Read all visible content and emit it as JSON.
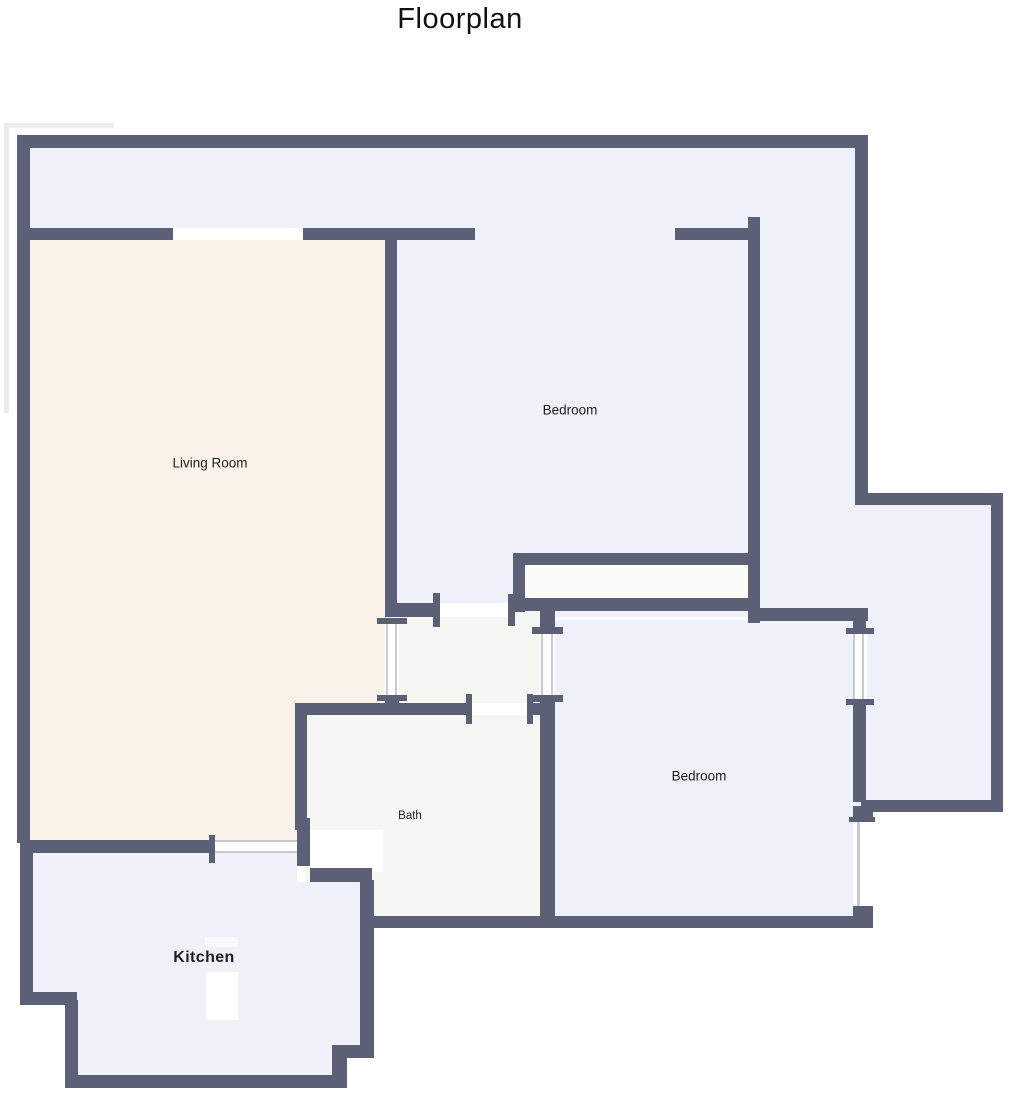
{
  "title": "Floorplan",
  "colors": {
    "wall": "#5b6076",
    "room_blue": "#eef1f9",
    "living_room": "#faf1e9",
    "bath": "#f6f6f2",
    "kitchen": "#f0f1f8",
    "closet": "#fbfbf7",
    "opening": "#ffffff",
    "window_line": "#c7cad4",
    "faint_outline": "#ededed",
    "label_text": "#1e1e1e"
  },
  "rooms": [
    {
      "id": "living-room",
      "label": "Living Room"
    },
    {
      "id": "bedroom-top",
      "label": "Bedroom"
    },
    {
      "id": "bedroom-bottom",
      "label": "Bedroom"
    },
    {
      "id": "bath",
      "label": "Bath"
    },
    {
      "id": "kitchen",
      "label": "Kitchen"
    }
  ]
}
